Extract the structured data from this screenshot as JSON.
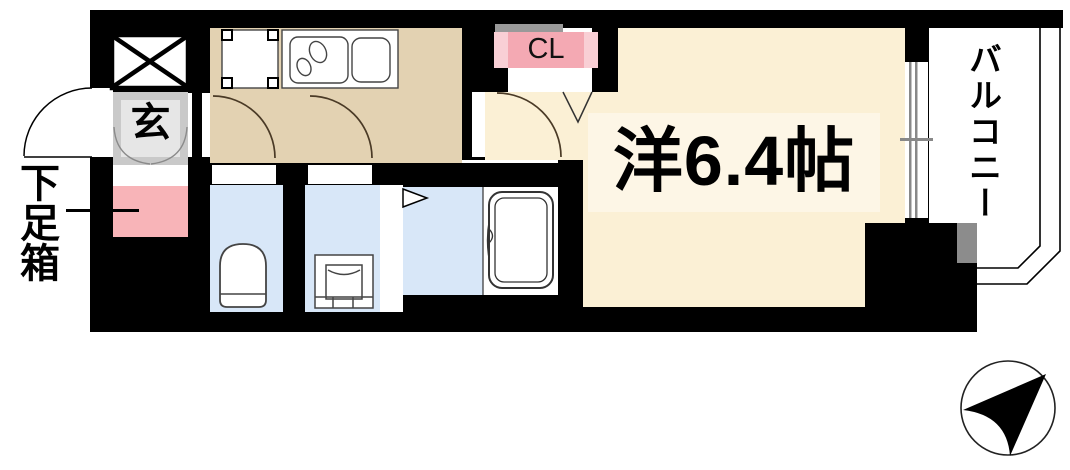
{
  "title": "apartment-floorplan",
  "labels": {
    "entrance": "玄",
    "shoe_box": "下足箱",
    "closet": "CL",
    "main_room": "洋6.4帖",
    "balcony": "バルコニー"
  },
  "colors": {
    "wall": "#000000",
    "kitchen_floor": "#e3d2b2",
    "room_floor": "#fbf0d5",
    "room_label_bg": "#fdf6e6",
    "wet_floor": "#d8e7f8",
    "entrance_tile": "#c9c9c9",
    "entrance_tile_inner": "#e6e6e6",
    "closet_pink": "#f4a9b3",
    "closet_pink_light": "#f9cfd5",
    "closet_shadow": "#999999",
    "shoe_box_pink": "#f8b4b8",
    "balcony_divider": "#8c8c8c",
    "window_glass": "#888888",
    "fixture_line": "#444444",
    "door_arc": "#4a3a26"
  },
  "compass": {
    "icon": "north-arrow"
  }
}
